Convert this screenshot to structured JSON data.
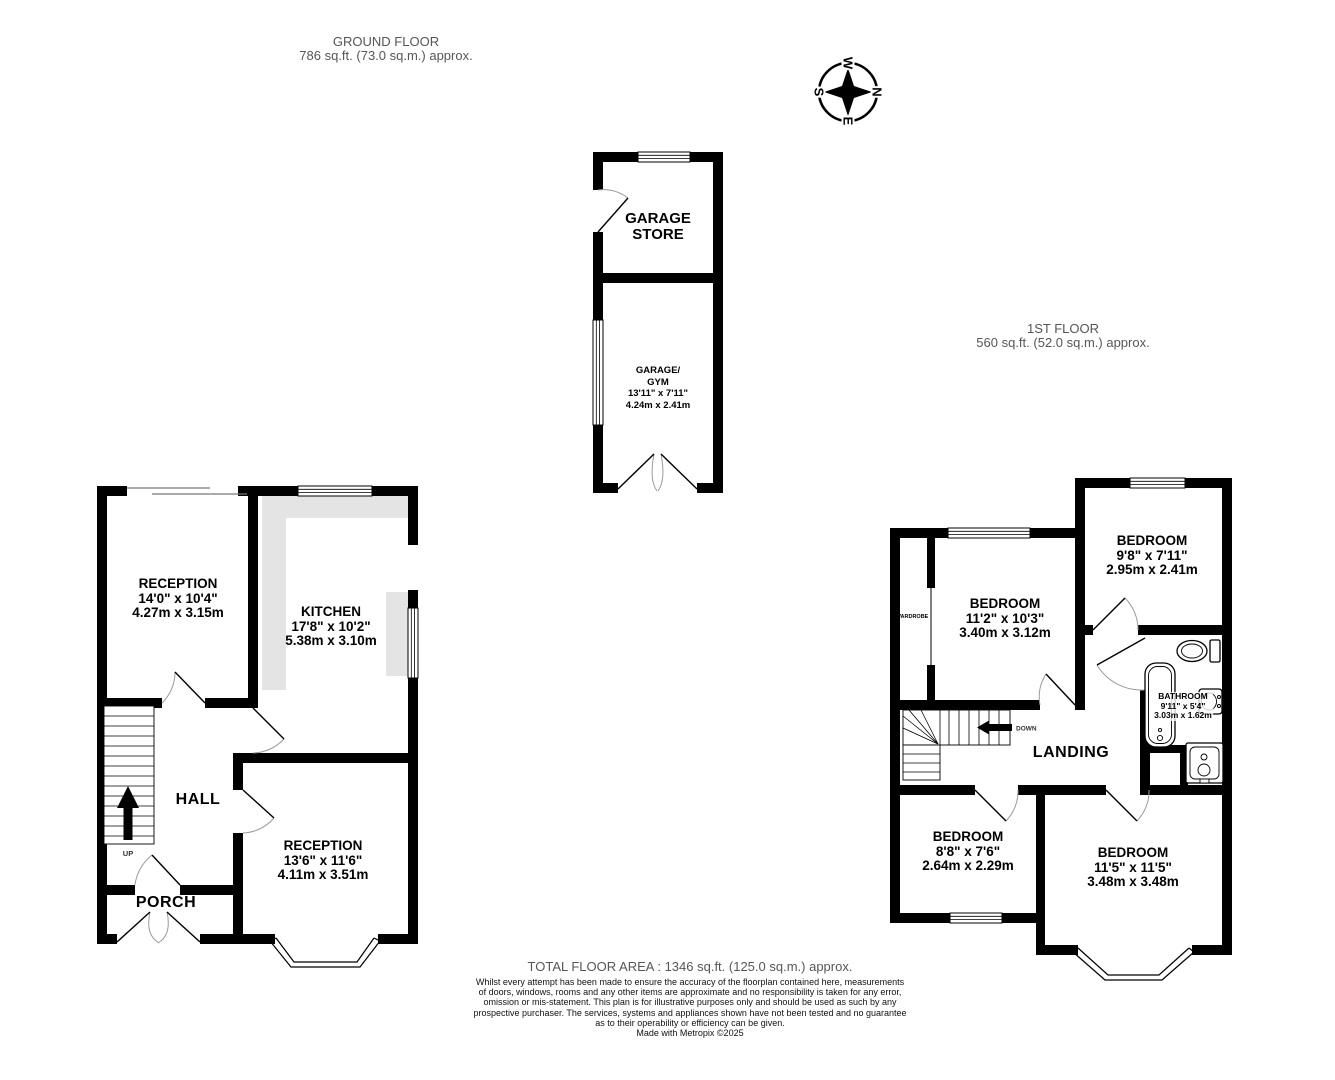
{
  "header": {
    "ground_floor": {
      "title": "GROUND FLOOR",
      "area": "786 sq.ft. (73.0 sq.m.) approx."
    },
    "first_floor": {
      "title": "1ST FLOOR",
      "area": "560 sq.ft. (52.0 sq.m.) approx."
    }
  },
  "compass": {
    "n": "N",
    "e": "E",
    "s": "S",
    "w": "W"
  },
  "rooms": {
    "reception1": {
      "name": "RECEPTION",
      "imperial": "14'0\"  x 10'4\"",
      "metric": "4.27m  x 3.15m"
    },
    "kitchen": {
      "name": "KITCHEN",
      "imperial": "17'8\"  x 10'2\"",
      "metric": "5.38m  x 3.10m"
    },
    "hall": {
      "name": "HALL"
    },
    "porch": {
      "name": "PORCH"
    },
    "reception2": {
      "name": "RECEPTION",
      "imperial": "13'6\"  x 11'6\"",
      "metric": "4.11m  x 3.51m"
    },
    "garage_store": {
      "line1": "GARAGE",
      "line2": "STORE"
    },
    "garage_gym": {
      "line1": "GARAGE/",
      "line2": "GYM",
      "imperial": "13'11\"  x 7'11\"",
      "metric": "4.24m  x 2.41m"
    },
    "bedroom1": {
      "name": "BEDROOM",
      "imperial": "11'2\"  x 10'3\"",
      "metric": "3.40m  x 3.12m"
    },
    "bedroom2": {
      "name": "BEDROOM",
      "imperial": "9'8\"  x 7'11\"",
      "metric": "2.95m  x 2.41m"
    },
    "bedroom3": {
      "name": "BEDROOM",
      "imperial": "8'8\"  x 7'6\"",
      "metric": "2.64m  x 2.29m"
    },
    "bedroom4": {
      "name": "BEDROOM",
      "imperial": "11'5\"  x 11'5\"",
      "metric": "3.48m  x 3.48m"
    },
    "bathroom": {
      "name": "BATHROOM",
      "imperial": "9'11\"  x 5'4\"",
      "metric": "3.03m  x 1.62m"
    },
    "landing": {
      "name": "LANDING"
    },
    "wardrobe": {
      "name": "WARDROBE"
    }
  },
  "stairs": {
    "up_label": "UP",
    "down_label": "DOWN"
  },
  "footer": {
    "total": "TOTAL FLOOR AREA : 1346 sq.ft. (125.0 sq.m.) approx.",
    "disclaimer_lines": [
      "Whilst every attempt has been made to ensure the accuracy of the floorplan contained here, measurements",
      "of doors, windows, rooms and any other items are approximate and no responsibility is taken for any error,",
      "omission or mis-statement. This plan is for illustrative purposes only and should be used as such by any",
      "prospective purchaser. The services, systems and appliances shown have not been tested and no guarantee",
      "as to their operability or efficiency can be given."
    ],
    "credit": "Made with Metropix ©2025"
  },
  "colors": {
    "wall": "#000000",
    "counter": "#e4e4e4",
    "muted_text": "#565656",
    "door_arc": "#9a9a9a"
  }
}
